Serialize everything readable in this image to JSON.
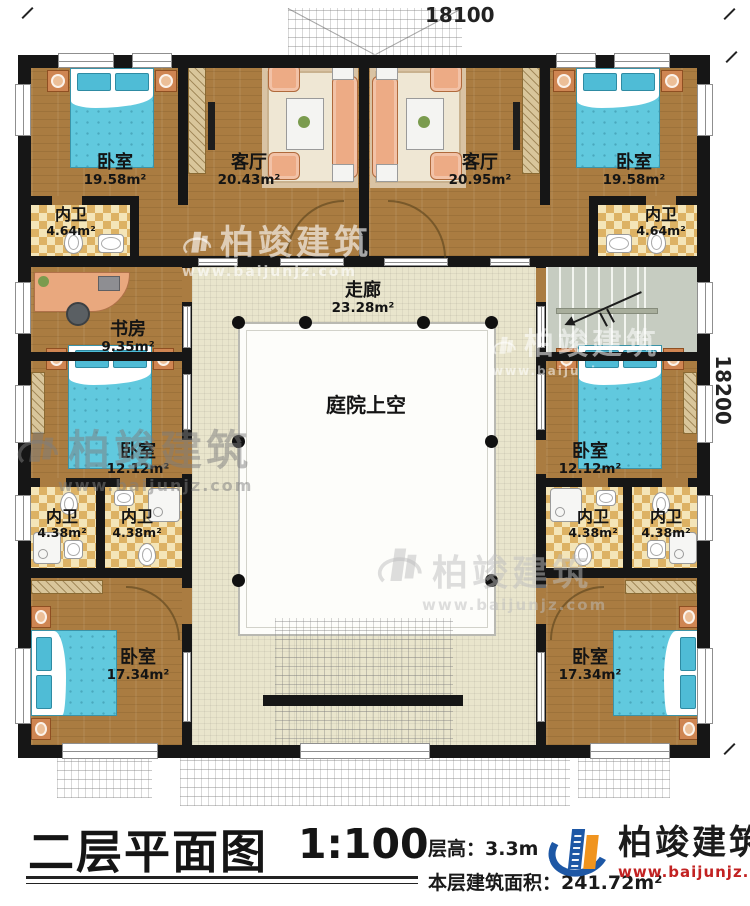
{
  "header": {
    "dim_top": "18100",
    "dim_right": "18200"
  },
  "rooms": {
    "bedroom_tl": {
      "name": "卧室",
      "area": "19.58m²"
    },
    "living_l": {
      "name": "客厅",
      "area": "20.43m²"
    },
    "living_r": {
      "name": "客厅",
      "area": "20.95m²"
    },
    "bedroom_tr": {
      "name": "卧室",
      "area": "19.58m²"
    },
    "bath_tl": {
      "name": "内卫",
      "area": "4.64m²"
    },
    "bath_tr": {
      "name": "内卫",
      "area": "4.64m²"
    },
    "study": {
      "name": "书房",
      "area": "9.35m²"
    },
    "corridor": {
      "name": "走廊",
      "area": "23.28m²"
    },
    "courtyard": {
      "name": "庭院上空"
    },
    "bedroom_ml": {
      "name": "卧室",
      "area": "12.12m²"
    },
    "bedroom_mr": {
      "name": "卧室",
      "area": "12.12m²"
    },
    "bath_l1": {
      "name": "内卫",
      "area": "4.38m²"
    },
    "bath_l2": {
      "name": "内卫",
      "area": "4.38m²"
    },
    "bath_r1": {
      "name": "内卫",
      "area": "4.38m²"
    },
    "bath_r2": {
      "name": "内卫",
      "area": "4.38m²"
    },
    "bedroom_bl": {
      "name": "卧室",
      "area": "17.34m²"
    },
    "bedroom_br": {
      "name": "卧室",
      "area": "17.34m²"
    }
  },
  "titleblock": {
    "title": "二层平面图",
    "scale": "1:100",
    "floor_height": "层高：3.3m",
    "floor_area": "本层建筑面积：241.72m²"
  },
  "branding": {
    "name": "柏竣建筑",
    "url": "www.baijunjz.com"
  }
}
